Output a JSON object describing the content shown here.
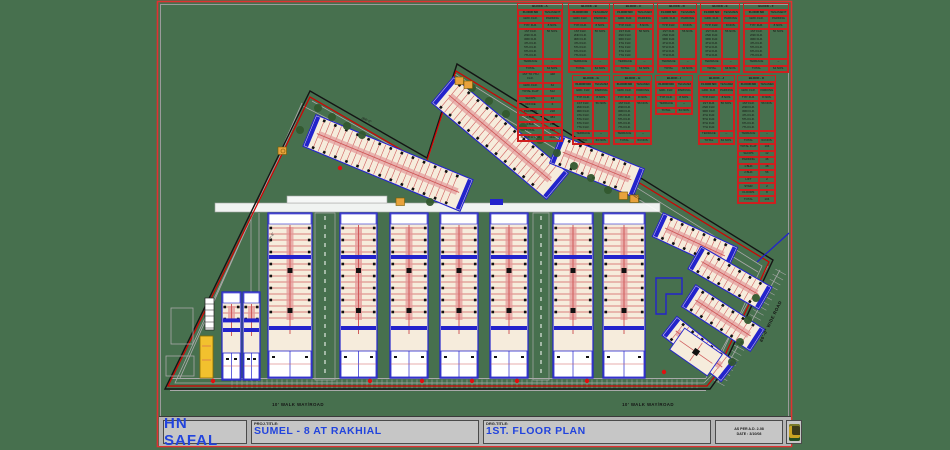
{
  "colors": {
    "background": "#47704e",
    "sheet_border_red": "#e03131",
    "sheet_border_gray": "#9b9b9b",
    "boundary_black": "#141414",
    "boundary_red": "#d40000",
    "road_gray": "#a9a9a9",
    "building_blue": "#2323cc",
    "building_cream": "#f6ecdc",
    "unit_pink": "#e49a9a",
    "unit_red": "#cf5b5b",
    "detail_black": "#111111",
    "highlight_yellow": "#f2c12e",
    "orange": "#e8a23c",
    "table_red": "#cf1f1f",
    "table_text": "#131313",
    "title_blue": "#2244dd",
    "titleblock_bg": "#b4b4b4",
    "titleblock_cell": "#c6c6c6",
    "tree_green": "#33592e",
    "marker_red": "#e01010",
    "white": "#ffffff"
  },
  "sheet": {
    "brand": "HN SAFAL",
    "proj_label": "PROJ.TITLE:",
    "proj_title": "SUMEL - 8  AT RAKHIAL",
    "drg_label": "DRG.TITLE:",
    "drg_title": "1ST. FLOOR PLAN",
    "note_line1": "AS PER A.D. 2-08",
    "note_line2": "DATE : 3/10/08"
  },
  "road_labels": [
    {
      "text": "10' WALK WAY/ROAD",
      "x": 298,
      "y": 406,
      "rot": 0
    },
    {
      "text": "10' WALK WAY/ROAD",
      "x": 648,
      "y": 406,
      "rot": 0
    },
    {
      "text": "60'-0\" WIDE ROAD",
      "x": 772,
      "y": 322,
      "rot": -64
    }
  ],
  "dimension_labels": [
    {
      "text": "352'-6\"",
      "x": 272,
      "y": 238,
      "rot": -64
    },
    {
      "text": "266'-0\"",
      "x": 366,
      "y": 121,
      "rot": 24
    },
    {
      "text": "410'-0\"",
      "x": 636,
      "y": 198,
      "rot": 40
    }
  ],
  "schedule": {
    "columns": [
      "FLOOR NO",
      "TENAMENT"
    ],
    "rows_top": [
      [
        "GRD. FLR.",
        "PARKING"
      ],
      [
        "TYP. FLR.",
        "8 NOS."
      ]
    ],
    "tall_left": "1ST FLR.\n2ND FLR.\n3RD FLR.\n4TH FLR.\n5TH FLR.\n6TH FLR.\n7TH FLR.",
    "tall_right": "56 NOS.",
    "rows_bottom": [
      [
        "TERRACE",
        "--"
      ],
      [
        "TOTAL",
        "64 NOS."
      ]
    ],
    "tables": [
      {
        "title": "BLOCK - A",
        "x": 517,
        "y": 3,
        "w": 46,
        "extra": [
          [
            "1ST TO 7TH FLR.",
            "448"
          ],
          [
            "GRD. FLR.",
            "64"
          ],
          [
            "TOTAL FLAT",
            "512"
          ],
          [
            "SHOPS",
            "24"
          ],
          [
            "OFFICE",
            "6"
          ],
          [
            "PARKING",
            "218"
          ],
          [
            "2 BHK",
            "384"
          ],
          [
            "3 BHK",
            "128"
          ],
          [
            "TOTAL",
            "512"
          ],
          [
            "BLOCK A TO K",
            "1144"
          ]
        ]
      },
      {
        "title": "BLOCK - B",
        "x": 568,
        "y": 3,
        "w": 42
      },
      {
        "title": "BLOCK - C",
        "x": 613,
        "y": 3,
        "w": 41
      },
      {
        "title": "BLOCK - D",
        "x": 657,
        "y": 3,
        "w": 40
      },
      {
        "title": "BLOCK - E",
        "x": 700,
        "y": 3,
        "w": 40
      },
      {
        "title": "BLOCK - F",
        "x": 743,
        "y": 3,
        "w": 46
      },
      {
        "title": "BLOCK - G",
        "x": 572,
        "y": 75,
        "w": 38
      },
      {
        "title": "BLOCK - H",
        "x": 613,
        "y": 75,
        "w": 39
      },
      {
        "title": "BLOCK - I",
        "x": 655,
        "y": 75,
        "w": 38,
        "short": true
      },
      {
        "title": "BLOCK - J",
        "x": 698,
        "y": 75,
        "w": 37
      },
      {
        "title": "BLOCK - K",
        "x": 737,
        "y": 75,
        "w": 39,
        "extra": [
          [
            "TOTAL FLAT",
            "104"
          ],
          [
            "SHOPS",
            "12"
          ],
          [
            "PARKING",
            "46"
          ],
          [
            "1 BHK",
            "48"
          ],
          [
            "2 BHK",
            "56"
          ],
          [
            "LIFT",
            "2"
          ],
          [
            "STAIR",
            "2"
          ],
          [
            "FLOORS",
            "8"
          ],
          [
            "TOTAL",
            "104"
          ]
        ]
      }
    ]
  }
}
